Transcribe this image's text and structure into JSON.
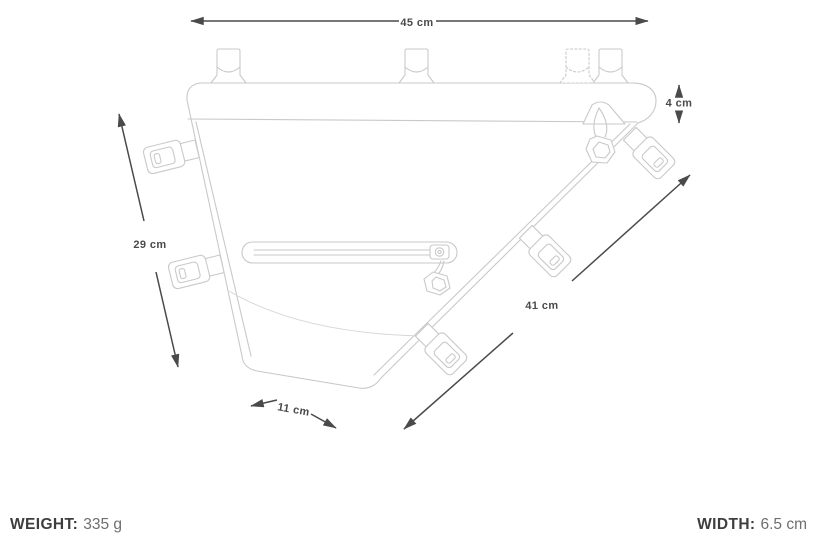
{
  "diagram": {
    "title": "frame-bag-dimension-drawing",
    "dimensions": {
      "top_width": "45 cm",
      "rail_height": "4 cm",
      "left_height": "29 cm",
      "diagonal_length": "41 cm",
      "bottom_width": "11 cm"
    },
    "colors": {
      "line_art": "#c9c9c9",
      "dimension_lines": "#4a4a4a",
      "background": "#ffffff"
    }
  },
  "footer": {
    "weight_label": "WEIGHT:",
    "weight_value": "335 g",
    "width_label": "WIDTH:",
    "width_value": "6.5 cm"
  }
}
